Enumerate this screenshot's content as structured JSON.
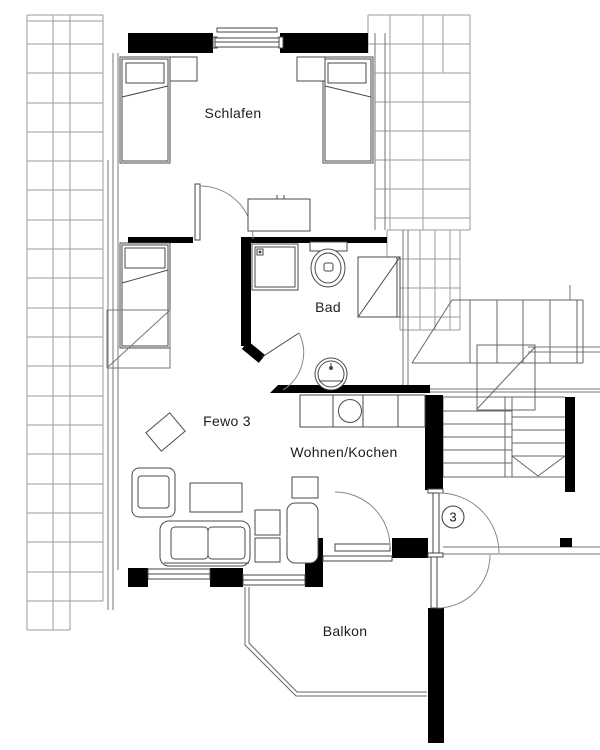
{
  "floorplan": {
    "rooms": {
      "schlafen": {
        "label": "Schlafen"
      },
      "bad": {
        "label": "Bad"
      },
      "fewo": {
        "label": "Fewo 3"
      },
      "wohnen_kochen": {
        "label": "Wohnen/Kochen"
      },
      "balkon": {
        "label": "Balkon"
      }
    },
    "unit_badge": "3",
    "colors": {
      "wall": "#000000",
      "furniture_line": "#4a4a4a",
      "thin_line": "#777777",
      "roof_grid": "#9b9b9b",
      "background": "#ffffff"
    },
    "elements": {
      "furniture": [
        "bed",
        "nightstand",
        "sideboard",
        "wardrobe",
        "shower",
        "toilet",
        "washbasin",
        "kitchen-counter",
        "kitchen-sink",
        "sofa",
        "armchair",
        "coffee-table",
        "side-table",
        "rug",
        "cabinet"
      ],
      "architecture": [
        "wall",
        "window",
        "door",
        "door-swing",
        "staircase",
        "roof-grid",
        "balcony-railing"
      ]
    }
  }
}
